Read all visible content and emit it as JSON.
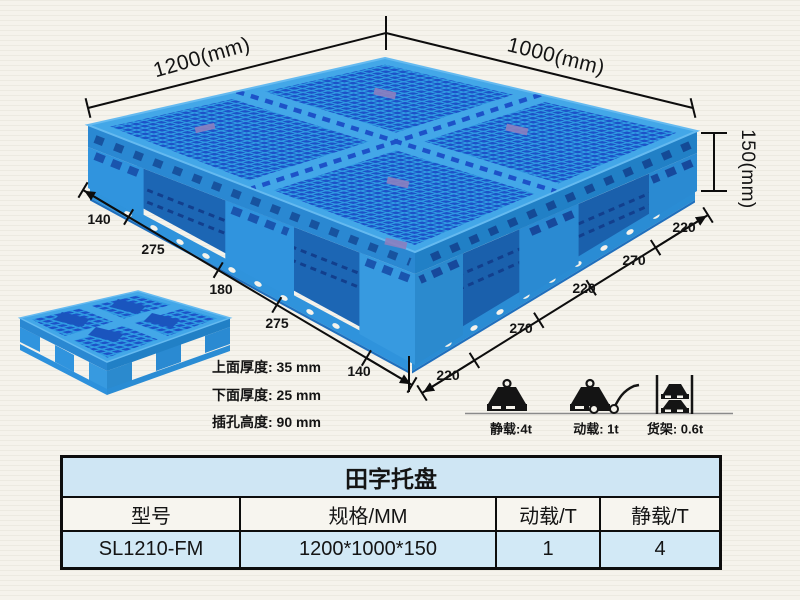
{
  "product": {
    "name": "田字托盘",
    "image_alt": "blue plastic grid pallet isometric view"
  },
  "dimensions": {
    "width_label": "1200(mm)",
    "depth_label": "1000(mm)",
    "height_label": "150(mm)",
    "left_edge_segments": [
      "140",
      "275",
      "180",
      "275",
      "140"
    ],
    "right_edge_segments": [
      "220",
      "270",
      "220",
      "270",
      "220"
    ]
  },
  "specs": {
    "top_thickness": "上面厚度: 35 mm",
    "bottom_thickness": "下面厚度: 25 mm",
    "fork_height": "插孔高度: 90 mm"
  },
  "load_ratings": {
    "static_label": "静载:4t",
    "dynamic_label": "动载: 1t",
    "rack_label": "货架: 0.6t"
  },
  "table": {
    "title": "田字托盘",
    "headers": [
      "型号",
      "规格/MM",
      "动载/T",
      "静载/T"
    ],
    "rows": [
      [
        "SL1210-FM",
        "1200*1000*150",
        "1",
        "4"
      ]
    ]
  },
  "colors": {
    "pallet_blue": "#2F9BE2",
    "pallet_hole_blue": "#1D52C8",
    "table_header_bg": "#CFE6F4",
    "background": "#F5F3EC"
  }
}
